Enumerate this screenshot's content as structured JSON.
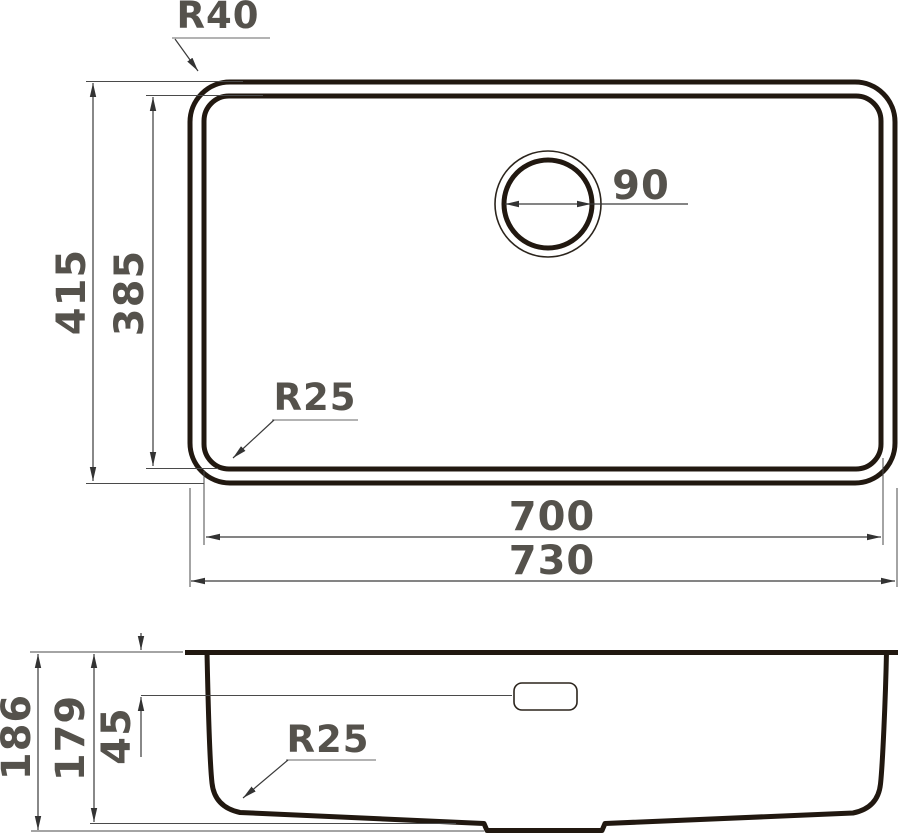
{
  "drawing": {
    "top_view": {
      "outer_corner_radius": "R40",
      "inner_corner_radius": "R25",
      "drain_diameter": "90",
      "outer_length": "415",
      "inner_length": "385",
      "inner_width": "700",
      "outer_width": "730"
    },
    "section_view": {
      "total_depth": "186",
      "bowl_depth": "179",
      "overflow_offset": "45",
      "bottom_corner_radius": "R25"
    },
    "colors": {
      "outline": "#211810",
      "dimension_line": "#3a3a3a",
      "leader_underline": "#9a9a9a",
      "label_text": "#55524c",
      "background": "#ffffff"
    }
  }
}
